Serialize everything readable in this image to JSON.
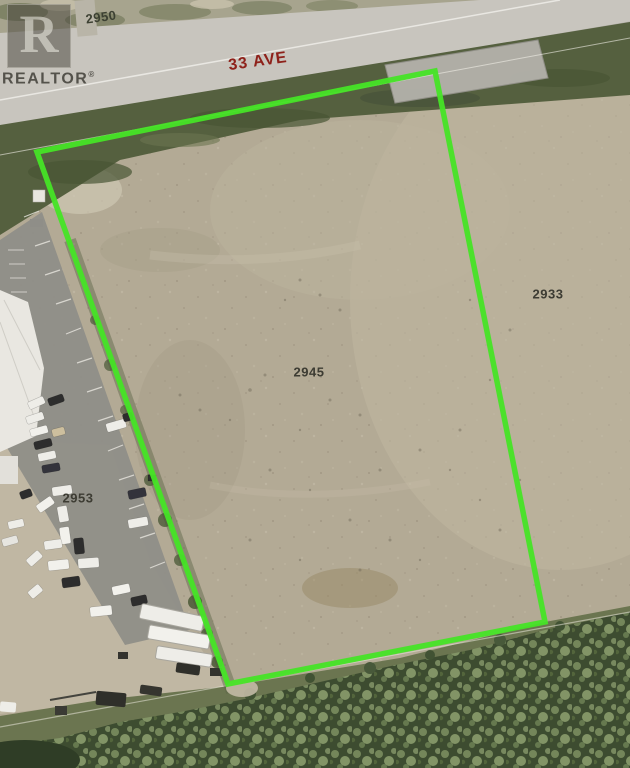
{
  "watermark": {
    "logo_letter": "R",
    "name": "REALTOR",
    "registered_mark": "®"
  },
  "labels": {
    "street": {
      "text": "33 AVE",
      "color": "#8e211a"
    },
    "parcels": [
      {
        "id": "2950"
      },
      {
        "id": "2933"
      },
      {
        "id": "2945"
      },
      {
        "id": "2953"
      }
    ]
  },
  "boundary": {
    "color": "#46e426",
    "points": "37,152 435,71 545,622 228,684"
  },
  "palette": {
    "dirt_field": "#b3aa95",
    "road": "#c8c5be",
    "roadside_grass": "#55603f",
    "forest": "#3d4c30",
    "parking_lot": "#8f8e88"
  }
}
